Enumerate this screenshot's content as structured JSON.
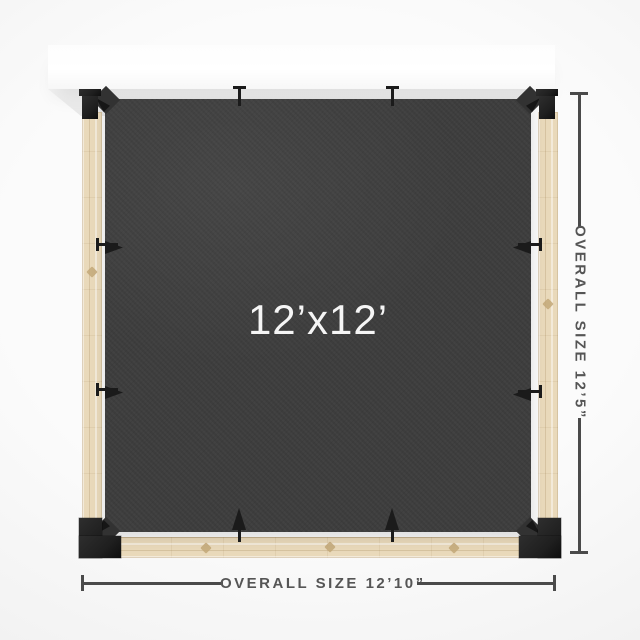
{
  "diagram": {
    "title": "Pergola shade canopy top view",
    "canopy_size_label": "12’x12’",
    "width_dimension_label": "OVERALL SIZE 12’10”",
    "height_dimension_label": "OVERALL SIZE 12’5”"
  },
  "colors": {
    "ledger": "#ffffff",
    "wood": "#e9d9ba",
    "wood-knot": "#c3a878",
    "bracket": "#1f1f1f",
    "fabric": "#3d3d3d",
    "fabric-label": "#f5f5f5",
    "dimension": "#4a4a4a",
    "dimension-text": "#555555"
  }
}
